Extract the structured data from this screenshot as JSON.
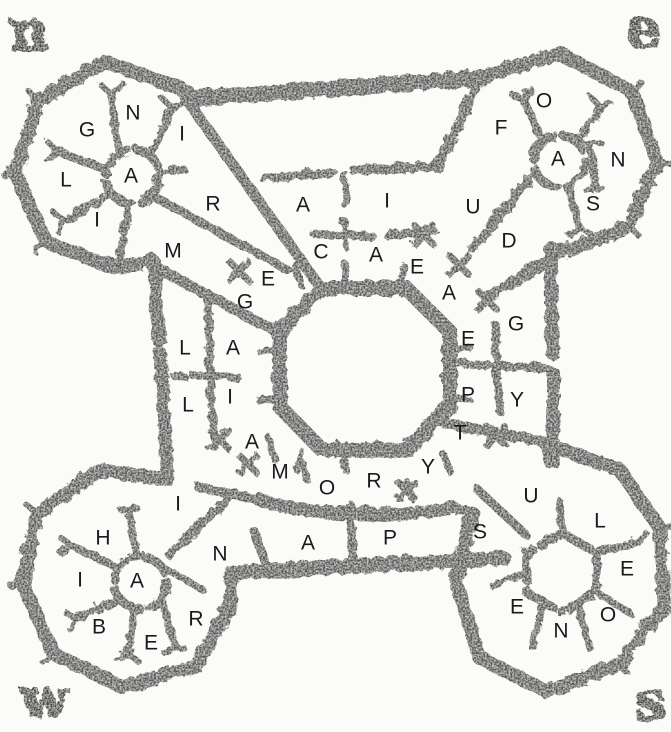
{
  "plan": {
    "description_label": "fortress-floor-plan-engraving",
    "colors": {
      "paper": "#fbfbf9",
      "wall": "#585858",
      "letter": "#1a1a1a",
      "compass": "#454545"
    },
    "compass": [
      {
        "corner": "nw",
        "ch": "n",
        "x": 27,
        "y": 48
      },
      {
        "corner": "ne",
        "ch": "e",
        "x": 641,
        "y": 46
      },
      {
        "corner": "sw",
        "ch": "w",
        "x": 42,
        "y": 716
      },
      {
        "corner": "se",
        "ch": "s",
        "x": 648,
        "y": 718
      }
    ],
    "letters": [
      {
        "area": "nw-bastion",
        "ch": "N",
        "x": 133,
        "y": 112
      },
      {
        "area": "nw-bastion",
        "ch": "G",
        "x": 87,
        "y": 129
      },
      {
        "area": "nw-bastion",
        "ch": "I",
        "x": 182,
        "y": 133
      },
      {
        "area": "nw-bastion",
        "ch": "L",
        "x": 66,
        "y": 179
      },
      {
        "area": "nw-bastion",
        "ch": "A",
        "x": 131,
        "y": 175
      },
      {
        "area": "nw-bastion",
        "ch": "I",
        "x": 97,
        "y": 219
      },
      {
        "area": "nw-gallery",
        "ch": "R",
        "x": 213,
        "y": 203
      },
      {
        "area": "nw-gallery",
        "ch": "M",
        "x": 173,
        "y": 250
      },
      {
        "area": "north-block",
        "ch": "A",
        "x": 303,
        "y": 204
      },
      {
        "area": "north-block",
        "ch": "I",
        "x": 387,
        "y": 200
      },
      {
        "area": "north-block",
        "ch": "C",
        "x": 321,
        "y": 251
      },
      {
        "area": "north-block",
        "ch": "A",
        "x": 376,
        "y": 254
      },
      {
        "area": "north-block",
        "ch": "E",
        "x": 417,
        "y": 266
      },
      {
        "area": "ne-gallery",
        "ch": "U",
        "x": 473,
        "y": 206
      },
      {
        "area": "ne-gallery",
        "ch": "D",
        "x": 509,
        "y": 240
      },
      {
        "area": "ne-bastion",
        "ch": "O",
        "x": 544,
        "y": 100
      },
      {
        "area": "ne-bastion",
        "ch": "F",
        "x": 501,
        "y": 127
      },
      {
        "area": "ne-bastion",
        "ch": "A",
        "x": 558,
        "y": 158
      },
      {
        "area": "ne-bastion",
        "ch": "N",
        "x": 618,
        "y": 159
      },
      {
        "area": "ne-bastion",
        "ch": "S",
        "x": 593,
        "y": 203
      },
      {
        "area": "west-block",
        "ch": "E",
        "x": 268,
        "y": 278
      },
      {
        "area": "west-block",
        "ch": "G",
        "x": 245,
        "y": 301
      },
      {
        "area": "west-block",
        "ch": "L",
        "x": 185,
        "y": 347
      },
      {
        "area": "west-block",
        "ch": "A",
        "x": 233,
        "y": 347
      },
      {
        "area": "west-block",
        "ch": "L",
        "x": 188,
        "y": 404
      },
      {
        "area": "west-block",
        "ch": "I",
        "x": 230,
        "y": 396
      },
      {
        "area": "east-block",
        "ch": "A",
        "x": 449,
        "y": 292
      },
      {
        "area": "east-block",
        "ch": "E",
        "x": 468,
        "y": 338
      },
      {
        "area": "east-block",
        "ch": "G",
        "x": 516,
        "y": 323
      },
      {
        "area": "east-block",
        "ch": "P",
        "x": 468,
        "y": 394
      },
      {
        "area": "east-block",
        "ch": "Y",
        "x": 517,
        "y": 399
      },
      {
        "area": "east-block",
        "ch": "T",
        "x": 460,
        "y": 432
      },
      {
        "area": "south-arc",
        "ch": "A",
        "x": 252,
        "y": 441
      },
      {
        "area": "south-arc",
        "ch": "M",
        "x": 280,
        "y": 471
      },
      {
        "area": "south-arc",
        "ch": "O",
        "x": 327,
        "y": 487
      },
      {
        "area": "south-arc",
        "ch": "R",
        "x": 374,
        "y": 480
      },
      {
        "area": "south-arc",
        "ch": "Y",
        "x": 428,
        "y": 466
      },
      {
        "area": "south-row",
        "ch": "A",
        "x": 308,
        "y": 542
      },
      {
        "area": "south-row",
        "ch": "P",
        "x": 390,
        "y": 537
      },
      {
        "area": "sw-gallery",
        "ch": "I",
        "x": 178,
        "y": 503
      },
      {
        "area": "sw-gallery",
        "ch": "N",
        "x": 220,
        "y": 553
      },
      {
        "area": "se-gallery",
        "ch": "S",
        "x": 480,
        "y": 531
      },
      {
        "area": "se-gallery",
        "ch": "U",
        "x": 531,
        "y": 495
      },
      {
        "area": "sw-bastion",
        "ch": "H",
        "x": 103,
        "y": 537
      },
      {
        "area": "sw-bastion",
        "ch": "I",
        "x": 80,
        "y": 579
      },
      {
        "area": "sw-bastion",
        "ch": "A",
        "x": 137,
        "y": 580
      },
      {
        "area": "sw-bastion",
        "ch": "B",
        "x": 99,
        "y": 626
      },
      {
        "area": "sw-bastion",
        "ch": "E",
        "x": 151,
        "y": 642
      },
      {
        "area": "sw-bastion",
        "ch": "R",
        "x": 196,
        "y": 618
      },
      {
        "area": "se-bastion",
        "ch": "L",
        "x": 600,
        "y": 520
      },
      {
        "area": "se-bastion",
        "ch": "E",
        "x": 627,
        "y": 568
      },
      {
        "area": "se-bastion",
        "ch": "O",
        "x": 608,
        "y": 614
      },
      {
        "area": "se-bastion",
        "ch": "N",
        "x": 561,
        "y": 630
      },
      {
        "area": "se-bastion",
        "ch": "E",
        "x": 517,
        "y": 606
      }
    ]
  }
}
